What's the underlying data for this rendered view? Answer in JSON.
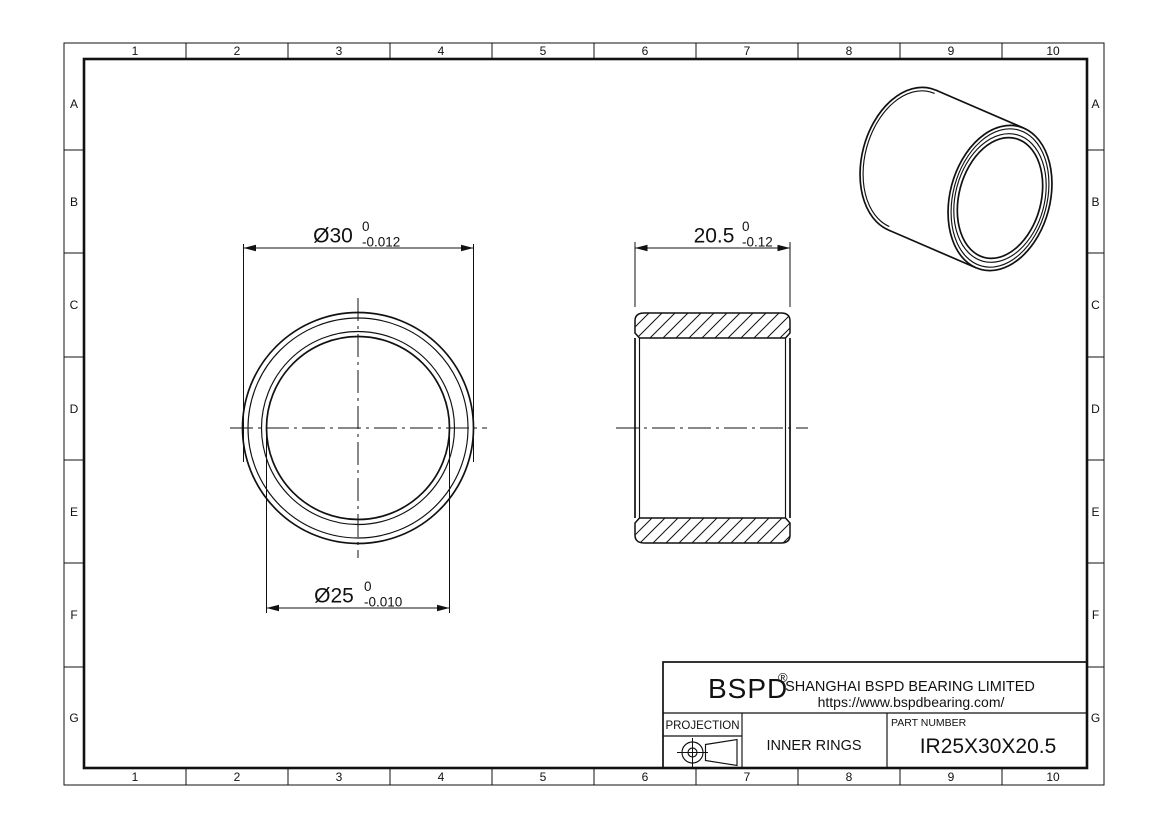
{
  "drawing": {
    "border": {
      "columns": [
        "1",
        "2",
        "3",
        "4",
        "5",
        "6",
        "7",
        "8",
        "9",
        "10"
      ],
      "rows": [
        "A",
        "B",
        "C",
        "D",
        "E",
        "F",
        "G"
      ]
    },
    "dimensions": {
      "outer_diameter": {
        "label": "Ø30",
        "tol_upper": "0",
        "tol_lower": "-0.012"
      },
      "bore_diameter": {
        "label": "Ø25",
        "tol_upper": "0",
        "tol_lower": "-0.010"
      },
      "width": {
        "label": "20.5",
        "tol_upper": "0",
        "tol_lower": "-0.12"
      }
    },
    "title_block": {
      "logo": "BSPD",
      "logo_reg": "®",
      "company": "SHANGHAI BSPD BEARING LIMITED",
      "website": "https://www.bspdbearing.com/",
      "projection_label": "PROJECTION",
      "product_type": "INNER RINGS",
      "part_number_label": "PART NUMBER",
      "part_number": "IR25X30X20.5"
    },
    "colors": {
      "line": "#111111",
      "background": "#ffffff"
    }
  }
}
